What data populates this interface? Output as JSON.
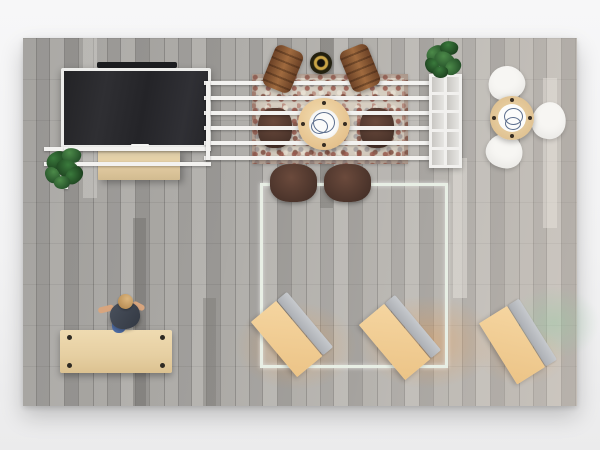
{
  "scene": {
    "view": "Top-down 3D render of an office-living room",
    "palette": {
      "wall": "#f4f4f5",
      "floor_base": "#a7a5a2",
      "floor_seam": "#8d8b88",
      "shelf_white": "#f2f1ef",
      "tv_frame": "#ededeb",
      "tv_screen": "#28282b",
      "console_wood": "#e0caa0",
      "rug_base": "#d6cec1",
      "rug_red": "#9a5a4e",
      "wood_chair_brown": "#8f5e37",
      "dark_chair_brown": "#4b342b",
      "white_chair": "#f7f6f3",
      "table_wood": "#e5c28e",
      "plant_green": "#2f6b33",
      "partition_glass": "#e8efe5",
      "desk_top_tan": "#f0cd97",
      "desk_screen_gray": "#b7babe",
      "glow_orange": "#f39a3c",
      "glow_green": "#9ccaa4",
      "person_shirt": "#3e4450",
      "person_hair": "#c79c62",
      "workbench_wood": "#e6cfa2"
    },
    "objects": {
      "tv": {
        "label": "flat-screen TV on white wall unit"
      },
      "soundbar": {
        "label": "dark soundbar above TV"
      },
      "media_console": {
        "label": "light wood media console"
      },
      "shelving_rails": {
        "label": "white horizontal shelving rails"
      },
      "bookshelf": {
        "label": "white cube bookshelf",
        "compartments": 10
      },
      "plant_left": {
        "label": "potted plant beside console"
      },
      "plant_shelf": {
        "label": "potted plant on bookshelf"
      },
      "rug": {
        "label": "patterned oriental area rug"
      },
      "dining_table": {
        "label": "round wood dining table with plates",
        "wood_chairs": 2,
        "dark_chairs": 4
      },
      "decor_pot": {
        "label": "dark and gold decorative bowl"
      },
      "cafe_table": {
        "label": "round cafe table",
        "white_chairs": 3
      },
      "glass_partition": {
        "label": "square glass partition room"
      },
      "angled_desks": {
        "label": "tilted desks with gray privacy screens",
        "count": 3
      },
      "workbench": {
        "label": "rectangular light wood desk with corner bolts",
        "bolts": 4
      },
      "person": {
        "label": "person leaning over desk"
      }
    }
  }
}
